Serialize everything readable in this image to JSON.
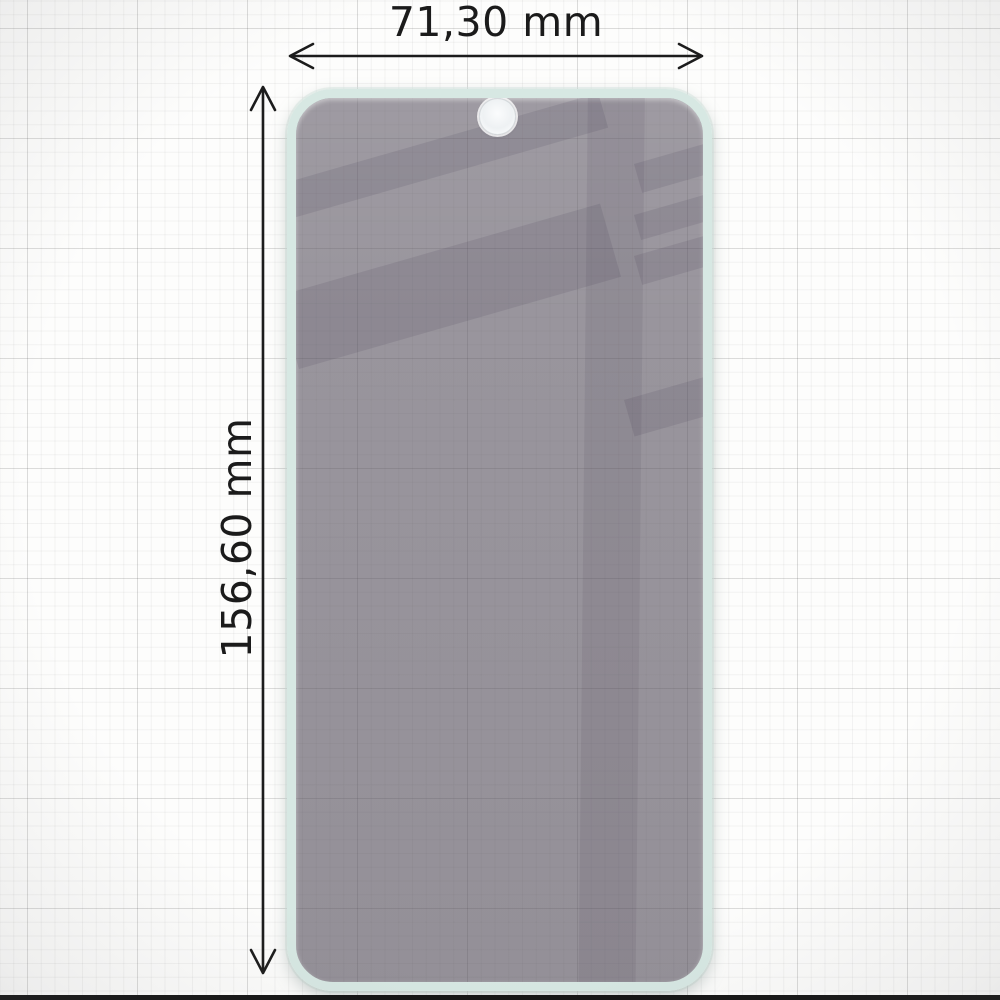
{
  "diagram": {
    "title": "screen protector dimension diagram",
    "width_label": "71,30 mm",
    "height_label": "156,60 mm"
  },
  "icons": {
    "width_arrow": "double-headed-horizontal-arrow",
    "height_arrow": "double-headed-vertical-arrow",
    "camera_hole": "punch-hole-camera-cutout"
  },
  "colors": {
    "dimension_text": "#1b1b1b",
    "dimension_line": "#1c1c1c",
    "film_tint": "#97939a",
    "film_reflection": "#8b8790",
    "glass_edge_mint": "#d7e8e3",
    "camera_hole_fill": "#f3f5f6",
    "background_paper": "#fdfdfc",
    "grid_minor": "#ededed",
    "grid_major": "#e0e0e0",
    "bottom_bar": "#141414"
  }
}
